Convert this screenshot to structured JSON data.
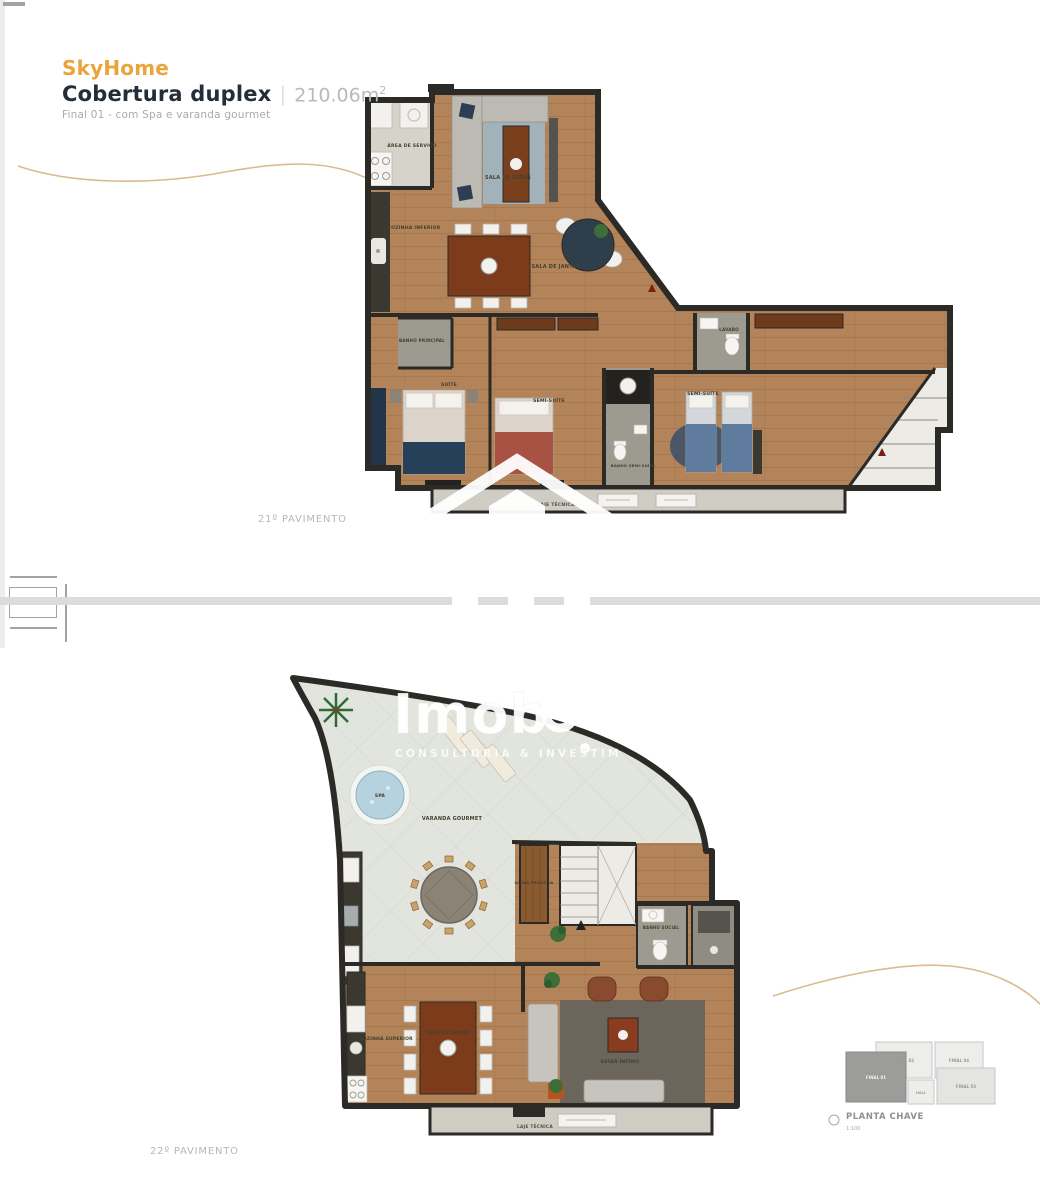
{
  "header": {
    "brand": "SkyHome",
    "title": "Cobertura duplex",
    "separator": "|",
    "area_value": "210.06m",
    "area_exponent": "2",
    "subtitle": "Final 01 - com Spa e varanda gourmet"
  },
  "floor1": {
    "caption": "21º PAVIMENTO",
    "rooms": {
      "area_servico": "ÁREA DE SERVIÇO",
      "sala_estar": "SALA DE ESTAR",
      "cozinha_inferior": "COZINHA INFERIOR",
      "sala_jantar": "SALA DE JANTAR",
      "banho_principal": "BANHO PRINCIPAL",
      "suite": "SUÍTE",
      "semi_suite": "SEMI-SUÍTE",
      "banho_semi_suite": "BANHO SEMI-SUÍTE",
      "lavabo": "LAVABO",
      "semi_suite_2": "SEMI-SUÍTE",
      "laje_tecnica": "LAJE TÉCNICA"
    }
  },
  "floor2": {
    "caption": "22º PAVIMENTO",
    "rooms": {
      "spa": "SPA",
      "varanda_gourmet": "VARANDA GOURMET",
      "sauna": "SAUNA PRIVATIVA",
      "banho_social": "BANHO SOCIAL",
      "cozinha_superior": "COZINHA SUPERIOR",
      "sala_jantar": "SALA DE JANTAR",
      "estar_intimo": "ESTAR ÍNTIMO",
      "laje_tecnica": "LAJE TÉCNICA"
    }
  },
  "watermark": {
    "brand": "Imob",
    "tagline": "CONSULTORIA & INVESTIM"
  },
  "key_plan": {
    "title": "PLANTA CHAVE",
    "scale": "1:100",
    "units": [
      {
        "label": "FINAL 02",
        "highlighted": false
      },
      {
        "label": "FINAL 04",
        "highlighted": false
      },
      {
        "label": "FINAL 01",
        "highlighted": true
      },
      {
        "label": "HALL",
        "highlighted": false
      },
      {
        "label": "FINAL 03",
        "highlighted": false
      }
    ]
  },
  "colors": {
    "brand_orange": "#E9A43C",
    "title_dark": "#242D39",
    "muted_gray": "#A6ABB0",
    "caption_gray": "#B5B8BA",
    "wall": "#2B2A26",
    "wood": "#B3835A",
    "terrace": "#E2E4DE",
    "wave_line": "#D9BB90",
    "spa_water": "#B5D2DE",
    "divider": "#DCDCDC"
  }
}
